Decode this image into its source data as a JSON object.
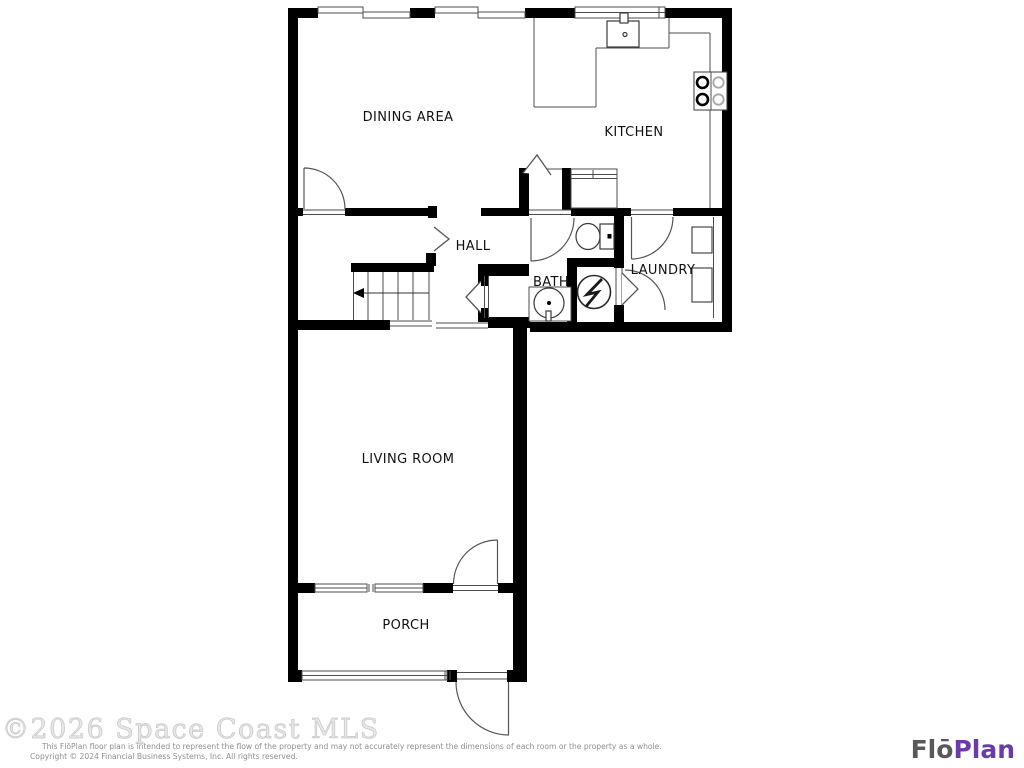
{
  "floor_plan": {
    "rooms": [
      {
        "id": "dining",
        "label": "DINING AREA"
      },
      {
        "id": "kitchen",
        "label": "KITCHEN"
      },
      {
        "id": "hall",
        "label": "HALL"
      },
      {
        "id": "bath",
        "label": "BATH"
      },
      {
        "id": "laundry",
        "label": "LAUNDRY"
      },
      {
        "id": "living",
        "label": "LIVING ROOM"
      },
      {
        "id": "porch",
        "label": "PORCH"
      }
    ],
    "fixtures": [
      "kitchen-sink",
      "cooktop-burners",
      "kitchen-counter",
      "closet-shelf",
      "toilet",
      "bathroom-sink",
      "water-heater",
      "washer",
      "dryer",
      "staircase",
      "stair-direction-arrow",
      "door-swings",
      "windows",
      "opening-arrows"
    ]
  },
  "watermark": {
    "text": "©2026 Space Coast MLS",
    "color": "#d9d9d9"
  },
  "disclaimer": {
    "line1": "This FlōPlan floor plan is intended to represent the flow of the property and may not accurately represent the dimensions of each room or the property as a whole.",
    "line2": "Copyright © 2024 Financial Business Systems, Inc. All rights reserved.",
    "color": "#8f8f8f"
  },
  "logo": {
    "part1": "Flō",
    "part2": "Plan",
    "part1_color": "#58595b",
    "part2_color": "#6c3ba6"
  },
  "colors": {
    "wall": "#000000",
    "thin_line": "#4d4d4d",
    "door_line": "#555555",
    "label_text": "#111111"
  }
}
